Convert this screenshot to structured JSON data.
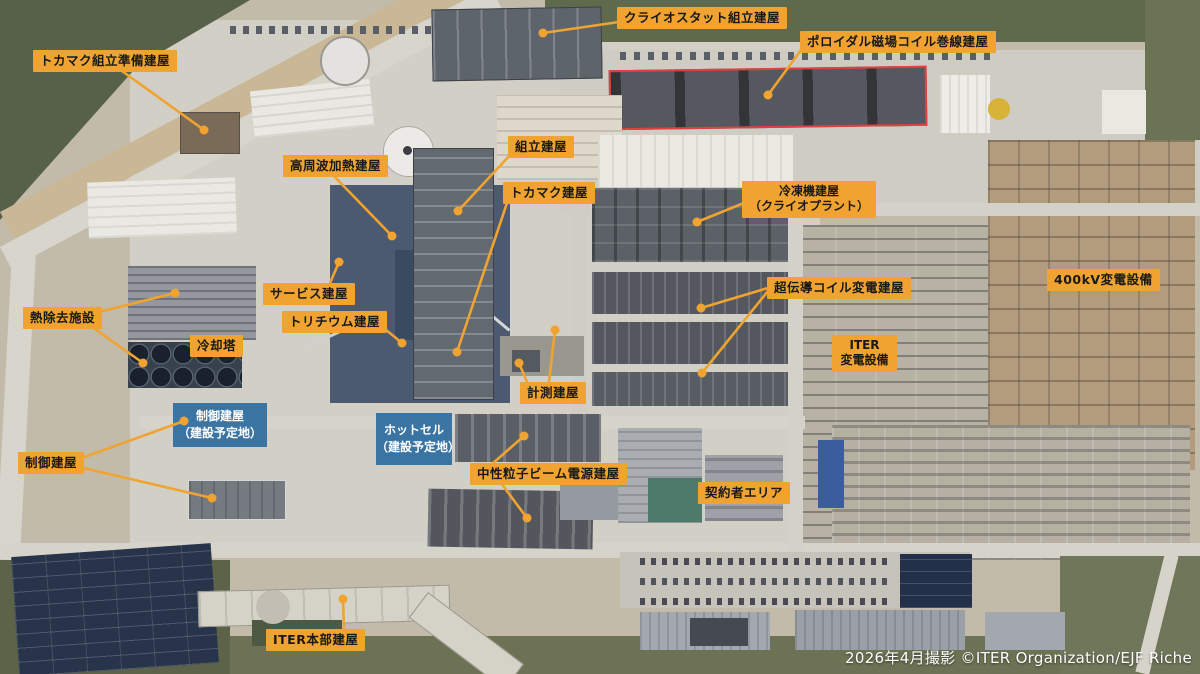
{
  "meta": {
    "caption": "2026年4月撮影  ©ITER Organization/EJF Riche",
    "site": "ITER建設サイト空撮（日本語注釈付き）"
  },
  "colors": {
    "label_background": "#F0A330",
    "label_text": "#191919",
    "leader_line": "#F0A330",
    "planned_overlay_blue": "#20649C",
    "planned_overlay_text": "#FFFFFF",
    "highlight_outline_red": "#E04040",
    "caption_text": "#FFFFFF"
  },
  "labels": [
    {
      "id": "tokamak-assembly-prep",
      "text": "トカマク組立準備建屋"
    },
    {
      "id": "cryostat-assembly",
      "text": "クライオスタット組立建屋"
    },
    {
      "id": "pf-coil-winding",
      "text": "ポロイダル磁場コイル巻線建屋"
    },
    {
      "id": "rf-heating",
      "text": "高周波加熱建屋"
    },
    {
      "id": "assembly-hall",
      "text": "組立建屋"
    },
    {
      "id": "tokamak-building",
      "text": "トカマク建屋"
    },
    {
      "id": "cryoplant",
      "line1": "冷凍機建屋",
      "line2": "（クライオプラント）"
    },
    {
      "id": "service-building",
      "text": "サービス建屋"
    },
    {
      "id": "heat-rejection",
      "text": "熱除去施設"
    },
    {
      "id": "cooling-tower",
      "text": "冷却塔"
    },
    {
      "id": "tritium-building",
      "text": "トリチウム建屋"
    },
    {
      "id": "sc-coil-substation",
      "text": "超伝導コイル変電建屋"
    },
    {
      "id": "substation-400kv",
      "text": "400kV変電設備"
    },
    {
      "id": "iter-substation",
      "line1": "ITER",
      "line2": "変電設備"
    },
    {
      "id": "diagnostics-building",
      "text": "計測建屋"
    },
    {
      "id": "neutral-beam-power",
      "text": "中性粒子ビーム電源建屋"
    },
    {
      "id": "contractor-area",
      "text": "契約者エリア"
    },
    {
      "id": "control-building",
      "text": "制御建屋"
    },
    {
      "id": "iter-headquarters",
      "text": "ITER本部建屋"
    }
  ],
  "overlays": [
    {
      "id": "control-building-planned",
      "line1": "制御建屋",
      "line2": "（建設予定地）"
    },
    {
      "id": "hot-cell-planned",
      "line1": "ホットセル",
      "line2": "（建設予定地）"
    }
  ]
}
